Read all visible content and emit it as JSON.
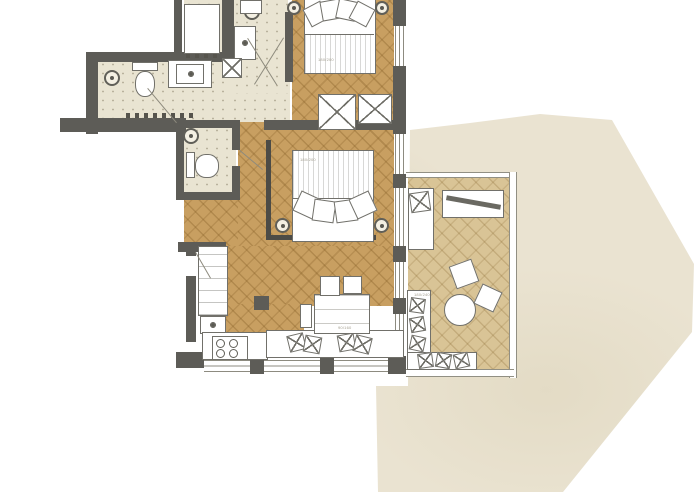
{
  "meta": {
    "description": "Hand-drawn watercolor style apartment floor plan with two bedrooms, two baths, WC, kitchen-living room and a large terrace",
    "width": 700,
    "height": 500
  },
  "palette": {
    "wall": "#5d5c57",
    "wood_floor": "#c89f61",
    "deck_floor": "#d9c496",
    "tile_floor": "#e9e4d2",
    "terrace_wash": "#eae3d1",
    "furniture_stroke": "#71706a",
    "background": "#ffffff"
  },
  "rooms": [
    {
      "name": "bedroom-top",
      "floor": "wood-herringbone",
      "furniture": [
        "double-bed",
        "two-nightstand-lamps",
        "two-wardrobes"
      ]
    },
    {
      "name": "bedroom-middle",
      "floor": "wood-herringbone",
      "furniture": [
        "double-bed",
        "two-nightstand-lamps",
        "headboard-partition"
      ]
    },
    {
      "name": "bathroom-left",
      "floor": "speckled-tile",
      "fixtures": [
        "floor-drain",
        "toilet",
        "vanity-sink",
        "door"
      ]
    },
    {
      "name": "bathroom-top",
      "floor": "speckled-tile",
      "fixtures": [
        "shower-tray",
        "floor-drain",
        "vanity-sink",
        "shaft"
      ]
    },
    {
      "name": "wc",
      "floor": "speckled-tile",
      "fixtures": [
        "toilet",
        "round-sink"
      ]
    },
    {
      "name": "kitchen-living",
      "floor": "wood-herringbone",
      "furniture": [
        "tall-cabinets",
        "oven",
        "cooktop",
        "counter",
        "window-bench",
        "dining-table",
        "three-chairs",
        "column"
      ]
    },
    {
      "name": "covered-terrace",
      "floor": "deck-herringbone",
      "furniture": [
        "lounge-chair",
        "plank-table",
        "two-seat-cushions",
        "round-table",
        "corner-sofa"
      ]
    },
    {
      "name": "open-terrace",
      "floor": "watercolor-wash",
      "furniture": []
    }
  ],
  "labels": {
    "bed_top": "180/200",
    "bed_middle": "180/200",
    "dining_table": "90/160",
    "terrace_sofa": "180/240"
  }
}
